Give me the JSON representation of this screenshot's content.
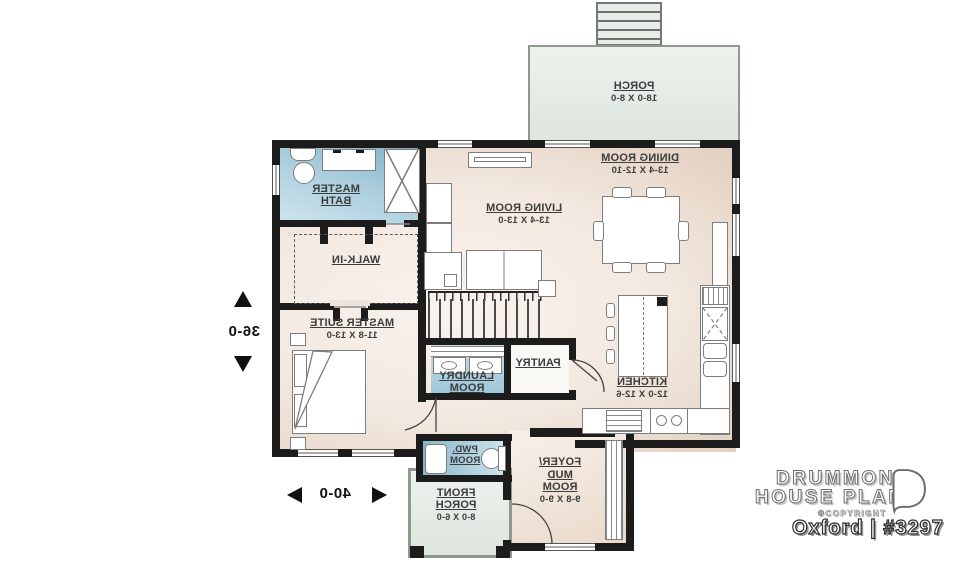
{
  "plan": {
    "mirrored": true,
    "rooms": {
      "porch": {
        "name": "PORCH",
        "dims": "18-0 X 8-0"
      },
      "dining": {
        "name": "DINING ROOM",
        "dims": "13-4 X 12-10"
      },
      "living": {
        "name": "LIVING ROOM",
        "dims": "13-4 X 13-0"
      },
      "master_bath": {
        "name": "MASTER BATH"
      },
      "walk_in": {
        "name": "WALK-IN"
      },
      "master_suite": {
        "name": "MASTER SUITE",
        "dims": "11-8 X 13-0"
      },
      "kitchen": {
        "name": "KITCHEN",
        "dims": "12-0 X 12-6"
      },
      "pantry": {
        "name": "PANTRY"
      },
      "laundry": {
        "name": "LAUNDRY ROOM"
      },
      "powder": {
        "name": "PWD. ROOM"
      },
      "foyer": {
        "name": "FOYER/ MUD ROOM",
        "dims": "9-8 X 9-0"
      },
      "front_porch": {
        "name": "FRONT PORCH",
        "dims": "8-0 X 6-0"
      }
    },
    "overall_dims": {
      "depth": "36-0",
      "width": "40-0"
    }
  },
  "branding": {
    "logo_line1": "DRUMMOND",
    "logo_line2": "HOUSE PLANS",
    "copyright": "©COPYRIGHT",
    "plan_title": "Oxford | #3297"
  },
  "colors": {
    "wall": "#1c1c1c",
    "floor_light": "#f8f1ea",
    "floor_dark": "#d5bcaa",
    "bath_blue": "#8fbacd",
    "porch_green": "#e4eae2"
  }
}
